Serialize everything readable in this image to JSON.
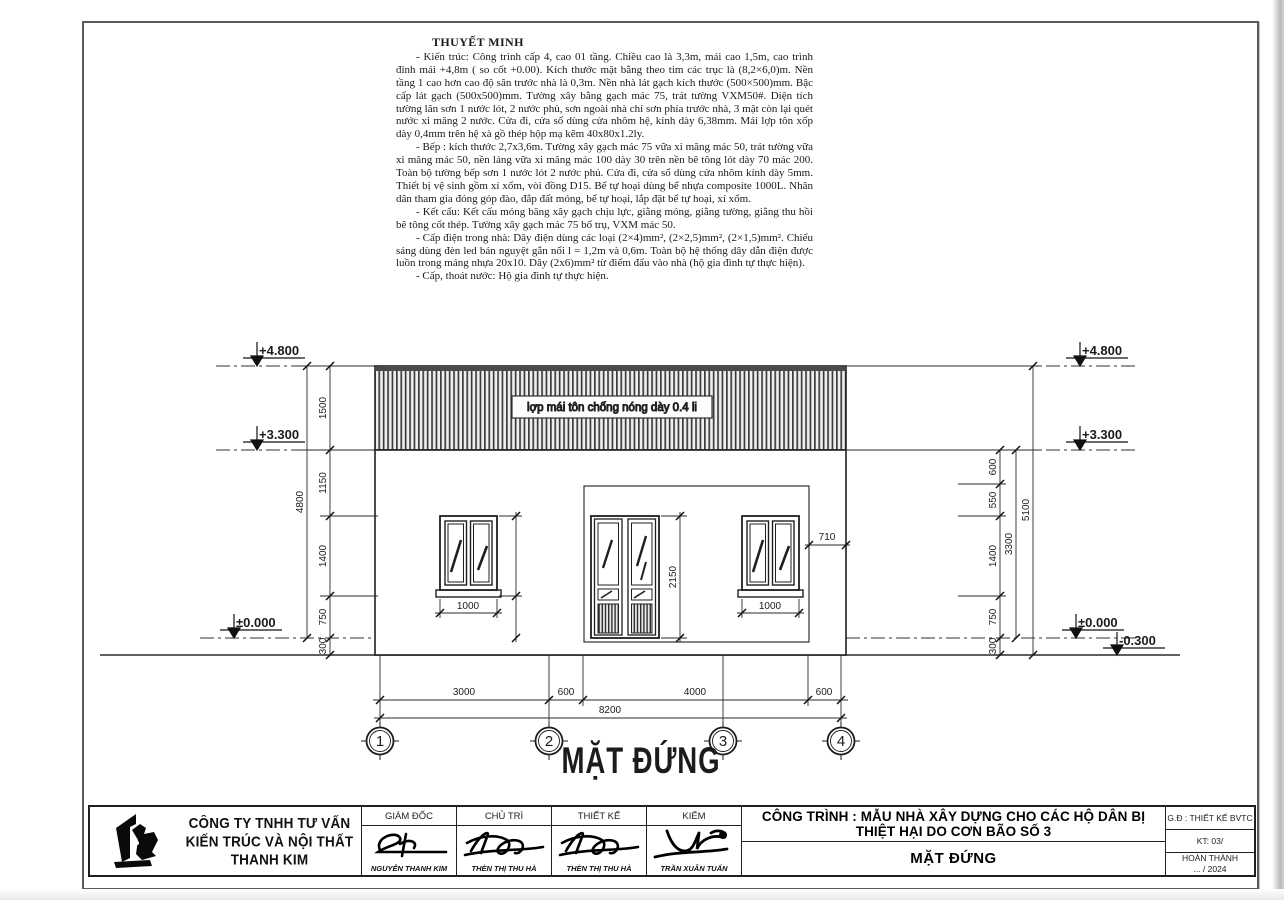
{
  "notes": {
    "title": "THUYẾT MINH",
    "p1": "- Kiến trúc: Công trình cấp 4, cao 01 tầng. Chiều cao là 3,3m, mái cao 1,5m, cao trình đỉnh mái +4,8m ( so cốt +0.00). Kích thước mặt bằng theo tim các trục là (8,2×6,0)m. Nền tầng 1 cao hơn cao độ sân trước nhà là 0,3m. Nền nhà lát gạch kích thước (500×500)mm. Bậc cấp lát gạch (500x500)mm. Tường xây bằng gạch mác 75, trát tường VXM50#. Diện tích tường lăn sơn 1 nước lót, 2 nước phủ, sơn ngoài nhà chỉ sơn phía trước nhà, 3 mặt còn lại quét nước xi măng 2 nước. Cửa đi, cửa sổ dùng cửa nhôm hệ, kính dày 6,38mm. Mái lợp tôn xốp dày 0,4mm trên hệ xà gồ thép hộp mạ kẽm 40x80x1.2ly.",
    "p2": "- Bếp : kích thước 2,7x3,6m. Tường xây gạch mác 75 vữa xi măng mác 50, trát tường vữa xi măng mác 50, nền láng vữa xi măng mác 100 dày 30 trên nền bê tông lót dày 70 mác 200. Toàn bộ tường bếp sơn 1 nước lót 2 nước phủ. Cửa đi, cửa sổ dùng cửa nhôm kính dày 5mm. Thiết bị vệ sinh gồm xí xổm, vòi đồng D15. Bể tự hoại dùng bể nhựa composite 1000L. Nhân dân tham gia đóng góp đào, đắp đất móng, bể tự hoại, lắp đặt bể tự hoại, xí xổm.",
    "p3": "- Kết cấu: Kết cấu móng băng xây gạch chịu lực, giằng móng, giằng tường, giằng thu hồi bê tông cốt thép. Tường xây gạch mác 75 bổ trụ, VXM mác 50.",
    "p4": "- Cấp điện trong nhà: Dây điện dùng các loại (2×4)mm², (2×2,5)mm², (2×1,5)mm². Chiếu sáng dùng đèn led bán nguyệt gắn nổi l = 1,2m và 0,6m. Toàn bộ hệ thống dây dẫn điện được luồn trong máng nhựa 20x10. Dây (2x6)mm² từ điểm đấu vào nhà (hộ gia đình tự thực hiện).",
    "p5": "- Cấp, thoát nước: Hộ gia đình tự thực hiện."
  },
  "drawing": {
    "title": "MẶT ĐỨNG",
    "roof_label": "lợp mái tôn chống nóng dày 0.4 li",
    "levels": {
      "p4800": "+4.800",
      "p3300": "+3.300",
      "zero": "±0.000",
      "m300": "-0.300"
    },
    "dims": {
      "d1500": "1500",
      "d1150": "1150",
      "d1400": "1400",
      "d750": "750",
      "d300": "300",
      "d4800": "4800",
      "d600": "600",
      "d550": "550",
      "d3300": "3300",
      "d5100": "5100",
      "win_w": "1000",
      "door_h": "2150",
      "d710": "710",
      "b3000": "3000",
      "b600a": "600",
      "b4000": "4000",
      "b600b": "600",
      "b8200": "8200"
    },
    "grid": {
      "g1": "1",
      "g2": "2",
      "g3": "3",
      "g4": "4"
    }
  },
  "titleblock": {
    "company_line1": "CÔNG TY TNHH TƯ VẤN",
    "company_line2": "KIẾN TRÚC VÀ NỘI THẤT THANH KIM",
    "roles": {
      "r1": "GIÁM ĐỐC",
      "r2": "CHỦ TRÌ",
      "r3": "THIẾT KẾ",
      "r4": "KIỂM"
    },
    "names": {
      "n1": "NGUYỄN THANH KIM",
      "n2": "THÈN THỊ THU HÀ",
      "n3": "THÈN THỊ THU HÀ",
      "n4": "TRẦN XUÂN TUẤN"
    },
    "project": "CÔNG TRÌNH : MẪU NHÀ XÂY DỰNG CHO CÁC HỘ DÂN BỊ THIỆT HẠI DO CƠN BÃO SỐ 3",
    "sheet_title": "MẶT ĐỨNG",
    "info1": "G.Đ : THIẾT KẾ BVTC",
    "info2": "KT: 03/",
    "info3a": "HOÀN THÀNH",
    "info3b": "... / 2024"
  }
}
